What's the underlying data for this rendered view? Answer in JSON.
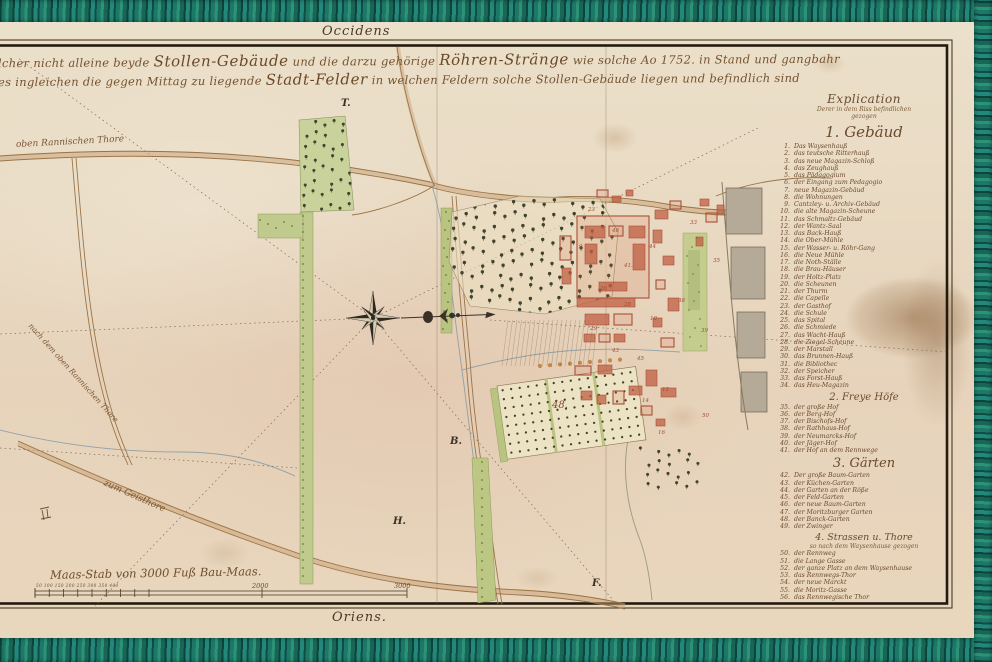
{
  "colors": {
    "linen_border": "#1d7867",
    "paper": "#e9dac3",
    "ink": "#6e4e2e",
    "building_red": "#a84f38",
    "garden_green": "#b9c480"
  },
  "map": {
    "orientation_top": "Occidens",
    "orientation_bottom": "Oriens.",
    "title_line1": [
      {
        "t": "lcher nicht alleine beyde ",
        "big": false
      },
      {
        "t": "Stollen-Gebäude",
        "big": true
      },
      {
        "t": " und die darzu gehörige ",
        "big": false
      },
      {
        "t": "Röhren-Stränge",
        "big": true
      },
      {
        "t": " wie solche Ao 1752. in Stand und gangbahr",
        "big": false
      }
    ],
    "title_line2": [
      {
        "t": "es ingleichen die gegen Mittag zu liegende ",
        "big": false
      },
      {
        "t": "Stadt-Felder",
        "big": true
      },
      {
        "t": " in welchen Feldern solche Stollen-Gebäude liegen und befindlich sind",
        "big": false
      }
    ],
    "labels": [
      {
        "text": "oben Rannischen Thore",
        "x": 16,
        "y": 140,
        "rot": -3,
        "size": 9
      },
      {
        "text": "nach dem oben Rannischen Thore",
        "x": 30,
        "y": 320,
        "rot": 48,
        "size": 7.5
      },
      {
        "text": "zum Geisthore",
        "x": 104,
        "y": 478,
        "rot": 24,
        "size": 9
      }
    ],
    "letters": [
      {
        "t": "T.",
        "x": 341,
        "y": 98
      },
      {
        "t": "H.",
        "x": 393,
        "y": 516
      },
      {
        "t": "F.",
        "x": 592,
        "y": 578
      },
      {
        "t": "B.",
        "x": 450,
        "y": 436
      }
    ],
    "numbers": [
      {
        "n": "23",
        "x": 588,
        "y": 207
      },
      {
        "n": "46",
        "x": 612,
        "y": 228
      },
      {
        "n": "44",
        "x": 649,
        "y": 244
      },
      {
        "n": "41.",
        "x": 624,
        "y": 263
      },
      {
        "n": "9",
        "x": 579,
        "y": 244
      },
      {
        "n": "26",
        "x": 600,
        "y": 286
      },
      {
        "n": "28",
        "x": 624,
        "y": 302
      },
      {
        "n": "10",
        "x": 650,
        "y": 316
      },
      {
        "n": "29",
        "x": 590,
        "y": 326
      },
      {
        "n": "43",
        "x": 612,
        "y": 348
      },
      {
        "n": "45",
        "x": 637,
        "y": 356
      },
      {
        "n": "12",
        "x": 662,
        "y": 387
      },
      {
        "n": "14",
        "x": 642,
        "y": 398
      },
      {
        "n": "38",
        "x": 678,
        "y": 298
      },
      {
        "n": "39",
        "x": 701,
        "y": 328
      },
      {
        "n": "33",
        "x": 690,
        "y": 220
      },
      {
        "n": "35",
        "x": 713,
        "y": 258
      },
      {
        "n": "16",
        "x": 658,
        "y": 430
      },
      {
        "n": "50",
        "x": 702,
        "y": 413
      },
      {
        "n": "48.",
        "x": 552,
        "y": 400,
        "big": true
      }
    ],
    "scale": {
      "label": "Maas-Stab von 3000 Fuß Bau-Maas.",
      "small_numbers": "50 100 150 200 250 300 350 400",
      "mid_number": "2000",
      "end_number": "3000"
    }
  },
  "legend": {
    "title": "Explication",
    "subtitle1": "Derer in dem Riss befindlichen",
    "subtitle2": "gezogen",
    "sections": [
      {
        "heading": "1. Gebäud",
        "items": [
          {
            "n": "1.",
            "label": "Das Waysenhauß"
          },
          {
            "n": "2.",
            "label": "das teutsche Ritterhauß"
          },
          {
            "n": "3.",
            "label": "das neue Magazin-Schloß"
          },
          {
            "n": "4.",
            "label": "das Zeughauß"
          },
          {
            "n": "5.",
            "label": "das Pädagogium"
          },
          {
            "n": "6.",
            "label": "der Eingang zum Pedagogio"
          },
          {
            "n": "7.",
            "label": "neue Magazin-Gebäud"
          },
          {
            "n": "8.",
            "label": "die Wohnungen"
          },
          {
            "n": "9.",
            "label": "Cantzley- u. Archiv-Gebäud"
          },
          {
            "n": "10.",
            "label": "die alte Magazin-Scheune"
          },
          {
            "n": "11.",
            "label": "das Schmaltz-Gebäud"
          },
          {
            "n": "12.",
            "label": "der Wantz-Saal"
          },
          {
            "n": "13.",
            "label": "das Back-Hauß"
          },
          {
            "n": "14.",
            "label": "die Ober-Mühle"
          },
          {
            "n": "15.",
            "label": "der Wasser- u. Röhr-Gang"
          },
          {
            "n": "16.",
            "label": "die Neue Mühle"
          },
          {
            "n": "17.",
            "label": "die Noth-Ställe"
          },
          {
            "n": "18.",
            "label": "die Brau-Häuser"
          },
          {
            "n": "19.",
            "label": "der Holtz-Platz"
          },
          {
            "n": "20.",
            "label": "die Scheunen"
          },
          {
            "n": "21.",
            "label": "der Thurm"
          },
          {
            "n": "22.",
            "label": "die Capelle"
          },
          {
            "n": "23.",
            "label": "der Gasthof"
          },
          {
            "n": "24.",
            "label": "die Schule"
          },
          {
            "n": "25.",
            "label": "das Spital"
          },
          {
            "n": "26.",
            "label": "die Schmiede"
          },
          {
            "n": "27.",
            "label": "das Wacht-Hauß"
          },
          {
            "n": "28.",
            "label": "die Ziegel-Scheune"
          },
          {
            "n": "29.",
            "label": "der Marstall"
          },
          {
            "n": "30.",
            "label": "das Brunnen-Hauß"
          },
          {
            "n": "31.",
            "label": "die Bibliothec"
          },
          {
            "n": "32.",
            "label": "der Speicher"
          },
          {
            "n": "33.",
            "label": "das Forst-Hauß"
          },
          {
            "n": "34.",
            "label": "das Heu-Magazin"
          }
        ]
      },
      {
        "heading": "2. Freye Höfe",
        "items": [
          {
            "n": "35.",
            "label": "der große Hof"
          },
          {
            "n": "36.",
            "label": "der Berg-Hof"
          },
          {
            "n": "37.",
            "label": "der Bischofs-Hof"
          },
          {
            "n": "38.",
            "label": "der Rathhaus-Hof"
          },
          {
            "n": "39.",
            "label": "der Neumarcks-Hof"
          },
          {
            "n": "40.",
            "label": "der Jäger-Hof"
          },
          {
            "n": "41.",
            "label": "der Hof an dem Rennwege"
          }
        ]
      },
      {
        "heading": "3. Gärten",
        "items": [
          {
            "n": "42.",
            "label": "Der große Baum-Garten"
          },
          {
            "n": "43.",
            "label": "der Küchen-Garten"
          },
          {
            "n": "44.",
            "label": "der Garten an der Röße"
          },
          {
            "n": "45.",
            "label": "der Feld-Garten"
          },
          {
            "n": "46.",
            "label": "der neue Baum-Garten"
          },
          {
            "n": "47.",
            "label": "der Moritzburger Garten"
          },
          {
            "n": "48.",
            "label": "der Banck-Garten"
          },
          {
            "n": "49.",
            "label": "der Zwinger"
          }
        ]
      },
      {
        "heading": "4. Strassen u. Thore",
        "subheading": "so nach dem Waysenhause gezogen",
        "items": [
          {
            "n": "50.",
            "label": "der Rennweg"
          },
          {
            "n": "51.",
            "label": "die Lange Gasse"
          },
          {
            "n": "52.",
            "label": "der ganze Platz an dem Waysenhause"
          },
          {
            "n": "53.",
            "label": "das Rennwegs-Thor"
          },
          {
            "n": "54.",
            "label": "der neue Marckt"
          },
          {
            "n": "55.",
            "label": "die Moritz-Gasse"
          },
          {
            "n": "56.",
            "label": "das Rennwegische Thor"
          }
        ]
      }
    ]
  }
}
